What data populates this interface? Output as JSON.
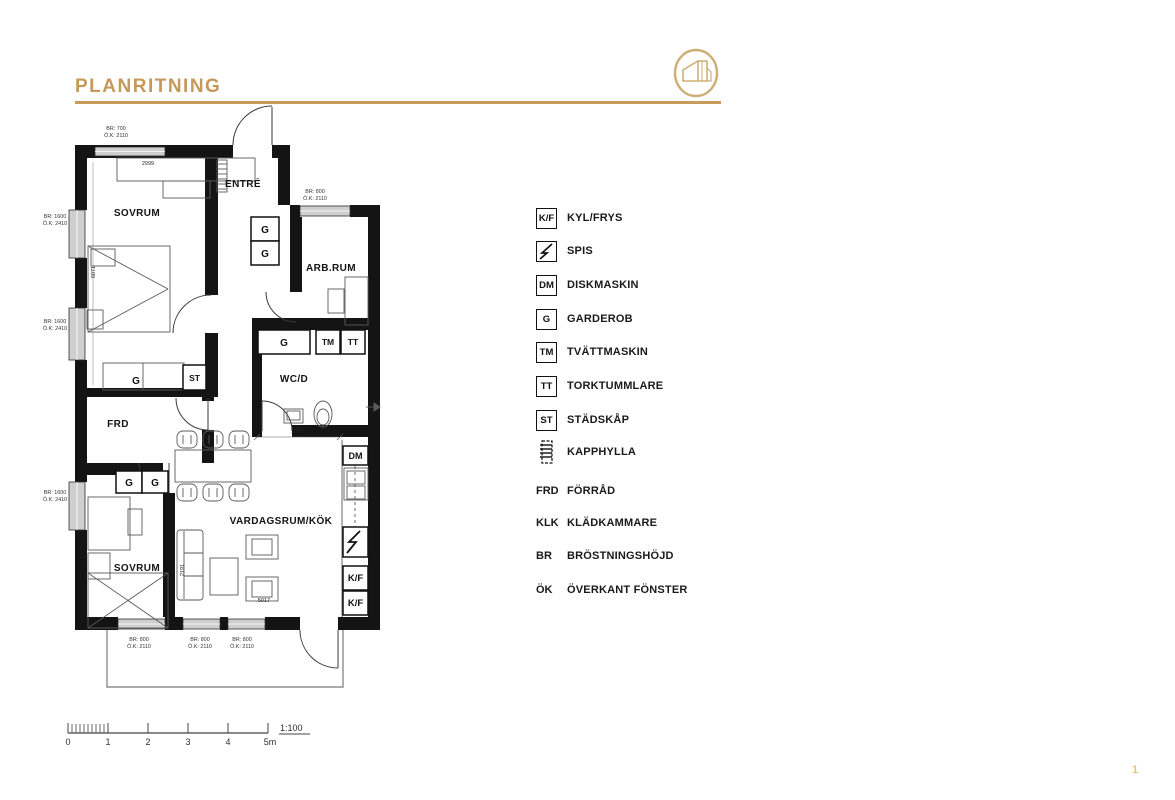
{
  "header": {
    "title": "PLANRITNING",
    "accent_color": "#C79B5C",
    "logo": "building-logo",
    "page_marker": "1"
  },
  "legend": {
    "items": [
      {
        "symbol": "K/F",
        "label": "KYL/FRYS",
        "icon": "box-abbr"
      },
      {
        "symbol": "",
        "label": "SPIS",
        "icon": "lightning"
      },
      {
        "symbol": "DM",
        "label": "DISKMASKIN",
        "icon": "box-abbr"
      },
      {
        "symbol": "G",
        "label": "GARDEROB",
        "icon": "box-abbr"
      },
      {
        "symbol": "TM",
        "label": "TVÄTTMASKIN",
        "icon": "box-abbr"
      },
      {
        "symbol": "TT",
        "label": "TORKTUMMLARE",
        "icon": "box-abbr"
      },
      {
        "symbol": "ST",
        "label": "STÄDSKÅP",
        "icon": "box-abbr"
      },
      {
        "symbol": "",
        "label": "KAPPHYLLA",
        "icon": "coat-rack"
      },
      {
        "symbol": "FRD",
        "label": "FÖRRÅD",
        "icon": "abbr"
      },
      {
        "symbol": "KLK",
        "label": "KLÄDKAMMARE",
        "icon": "abbr"
      },
      {
        "symbol": "BR",
        "label": "BRÖSTNINGSHÖJD",
        "icon": "abbr"
      },
      {
        "symbol": "ÖK",
        "label": "ÖVERKANT FÖNSTER",
        "icon": "abbr"
      }
    ]
  },
  "plan": {
    "rooms": [
      {
        "name": "SOVRUM",
        "x": 137,
        "y": 213
      },
      {
        "name": "ENTRÉ",
        "x": 243,
        "y": 184
      },
      {
        "name": "ARB.RUM",
        "x": 331,
        "y": 268
      },
      {
        "name": "WC/D",
        "x": 294,
        "y": 379
      },
      {
        "name": "FRD",
        "x": 118,
        "y": 424
      },
      {
        "name": "VARDAGSRUM/KÖK",
        "x": 281,
        "y": 521
      },
      {
        "name": "SOVRUM",
        "x": 137,
        "y": 568
      }
    ],
    "boxes": [
      {
        "label": "G",
        "x": 251,
        "y": 217,
        "w": 28,
        "h": 24
      },
      {
        "label": "G",
        "x": 251,
        "y": 241,
        "w": 28,
        "h": 24
      },
      {
        "label": "G",
        "x": 258,
        "y": 330,
        "w": 52,
        "h": 24
      },
      {
        "label": "TM",
        "x": 316,
        "y": 330,
        "w": 24,
        "h": 24
      },
      {
        "label": "TT",
        "x": 341,
        "y": 330,
        "w": 24,
        "h": 24
      },
      {
        "label": "ST",
        "x": 183,
        "y": 365,
        "w": 23,
        "h": 25
      },
      {
        "label": "G",
        "x": 116,
        "y": 471,
        "w": 26,
        "h": 22
      },
      {
        "label": "G",
        "x": 142,
        "y": 471,
        "w": 26,
        "h": 22
      },
      {
        "label": "DM",
        "x": 343,
        "y": 446,
        "w": 25,
        "h": 19
      },
      {
        "label": "K/F",
        "x": 343,
        "y": 566,
        "w": 25,
        "h": 24
      },
      {
        "label": "K/F",
        "x": 343,
        "y": 591,
        "w": 25,
        "h": 24
      }
    ],
    "closet_label": {
      "text": "G",
      "x": 136,
      "y": 381
    },
    "dimensions": [
      {
        "text": "2999",
        "x": 148,
        "y": 165,
        "rot": 0
      },
      {
        "text": "6071",
        "x": 95,
        "y": 272,
        "rot": -90
      },
      {
        "text": "1899",
        "x": 297,
        "y": 433,
        "rot": 0
      },
      {
        "text": "2191",
        "x": 184,
        "y": 570,
        "rot": -90
      },
      {
        "text": "5017",
        "x": 264,
        "y": 602,
        "rot": 0
      }
    ],
    "window_labels": [
      {
        "l1": "BR: 700",
        "l2": "Ö.K: 2110",
        "x": 116,
        "y": 127
      },
      {
        "l1": "BR: 1600",
        "l2": "Ö.K: 2410",
        "x": 55,
        "y": 215
      },
      {
        "l1": "BR: 1600",
        "l2": "Ö.K: 2410",
        "x": 55,
        "y": 320
      },
      {
        "l1": "BR: 1600",
        "l2": "Ö.K: 2410",
        "x": 55,
        "y": 491
      },
      {
        "l1": "BR: 800",
        "l2": "Ö.K: 2110",
        "x": 315,
        "y": 190
      },
      {
        "l1": "BR: 800",
        "l2": "Ö.K: 2110",
        "x": 139,
        "y": 638
      },
      {
        "l1": "BR: 800",
        "l2": "Ö.K: 2110",
        "x": 200,
        "y": 638
      },
      {
        "l1": "BR: 800",
        "l2": "Ö.K: 2110",
        "x": 242,
        "y": 638
      }
    ]
  },
  "scalebar": {
    "labels": [
      "0",
      "1",
      "2",
      "3",
      "4",
      "5m"
    ],
    "ratio": "1:100"
  }
}
